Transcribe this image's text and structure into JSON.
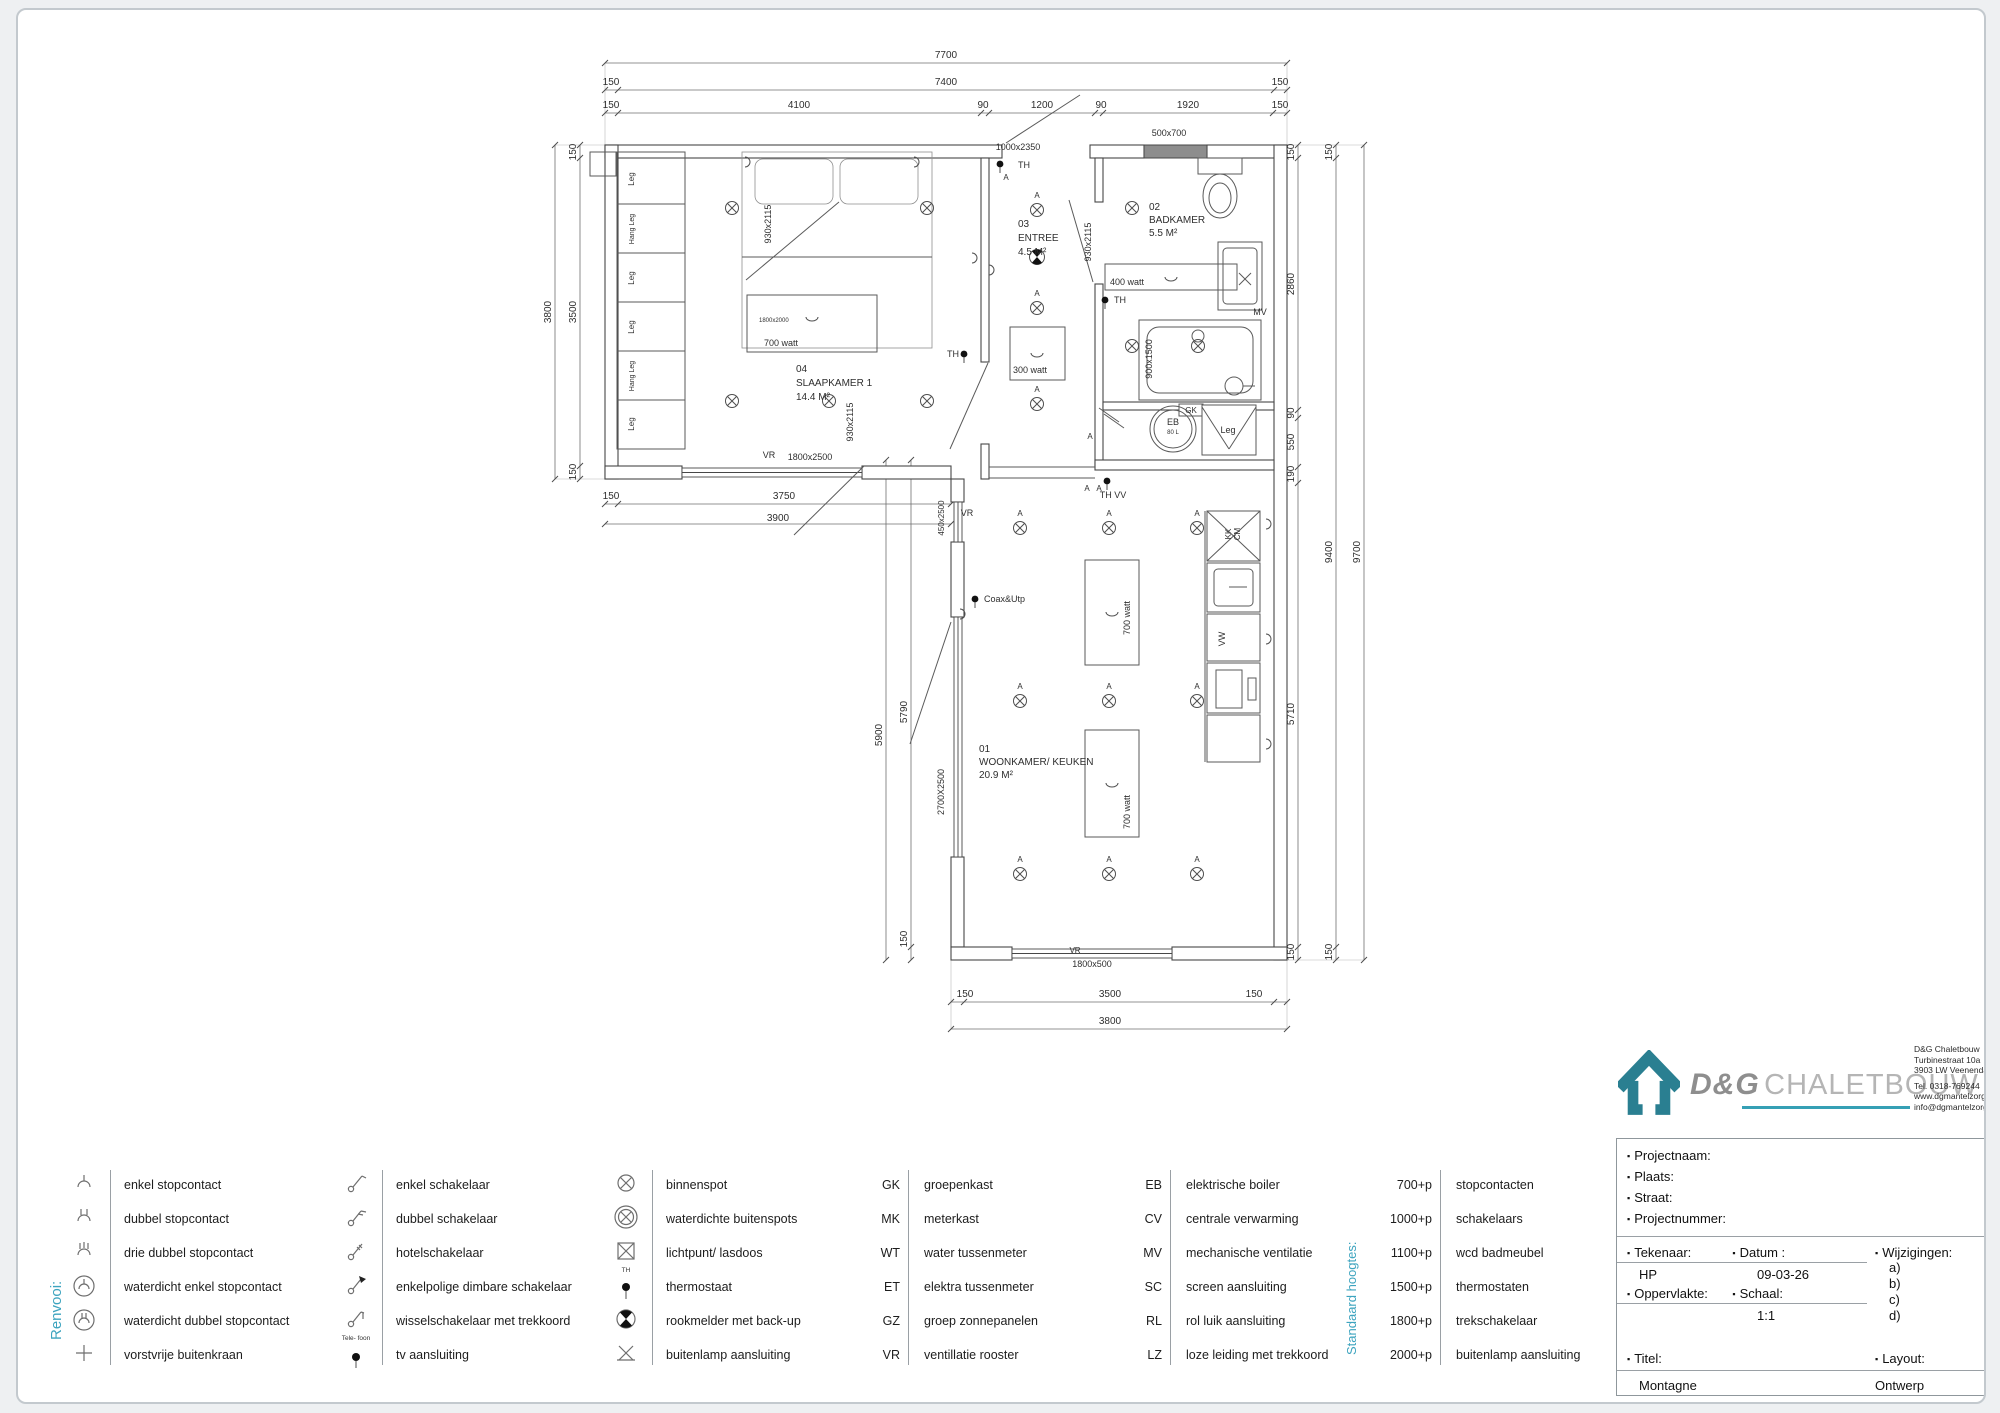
{
  "colors": {
    "teal_accent": "#3da4bf",
    "logo_teal": "#2a7f91",
    "line_dark": "#474747",
    "line_dim": "#6f6f6f"
  },
  "plan": {
    "labels": [
      [
        "7700",
        944,
        56,
        0,
        "middle",
        10
      ],
      [
        "150",
        609,
        83,
        0,
        "middle",
        10
      ],
      [
        "7400",
        944,
        83,
        0,
        "middle",
        10
      ],
      [
        "150",
        1278,
        83,
        0,
        "middle",
        10
      ],
      [
        "150",
        609,
        106,
        0,
        "middle",
        10
      ],
      [
        "4100",
        797,
        106,
        0,
        "middle",
        10
      ],
      [
        "90",
        981,
        106,
        0,
        "middle",
        10
      ],
      [
        "1200",
        1040,
        106,
        0,
        "middle",
        10
      ],
      [
        "90",
        1099,
        106,
        0,
        "middle",
        10
      ],
      [
        "1920",
        1186,
        106,
        0,
        "middle",
        10
      ],
      [
        "150",
        1278,
        106,
        0,
        "middle",
        10
      ],
      [
        "3800",
        549,
        310,
        -90,
        "middle",
        10
      ],
      [
        "150",
        574,
        150,
        -90,
        "middle",
        10
      ],
      [
        "3500",
        574,
        310,
        -90,
        "middle",
        10
      ],
      [
        "150",
        574,
        470,
        -90,
        "middle",
        10
      ],
      [
        "5900",
        880,
        733,
        -90,
        "middle",
        10
      ],
      [
        "5790",
        905,
        710,
        -90,
        "middle",
        10
      ],
      [
        "150",
        905,
        937,
        -90,
        "middle",
        10
      ],
      [
        "150",
        609,
        497,
        0,
        "middle",
        10
      ],
      [
        "3750",
        782,
        497,
        0,
        "middle",
        10
      ],
      [
        "3900",
        776,
        519,
        0,
        "middle",
        10
      ],
      [
        "150",
        1292,
        150,
        -90,
        "middle",
        10
      ],
      [
        "2860",
        1292,
        282,
        -90,
        "middle",
        10
      ],
      [
        "90",
        1292,
        411,
        -90,
        "middle",
        10
      ],
      [
        "550",
        1292,
        440,
        -90,
        "middle",
        10
      ],
      [
        "190",
        1292,
        472,
        -90,
        "middle",
        10
      ],
      [
        "5710",
        1292,
        712,
        -90,
        "middle",
        10
      ],
      [
        "150",
        1292,
        950,
        -90,
        "middle",
        10
      ],
      [
        "150",
        1330,
        150,
        -90,
        "middle",
        10
      ],
      [
        "9400",
        1330,
        550,
        -90,
        "middle",
        10
      ],
      [
        "150",
        1330,
        950,
        -90,
        "middle",
        10
      ],
      [
        "9700",
        1358,
        550,
        -90,
        "middle",
        10
      ],
      [
        "150",
        963,
        995,
        0,
        "middle",
        10
      ],
      [
        "3500",
        1108,
        995,
        0,
        "middle",
        10
      ],
      [
        "150",
        1252,
        995,
        0,
        "middle",
        10
      ],
      [
        "3800",
        1108,
        1022,
        0,
        "middle",
        10
      ],
      [
        "500x700",
        1167,
        134,
        0,
        "middle",
        9
      ],
      [
        "1000x2350",
        1016,
        148,
        0,
        "middle",
        9
      ],
      [
        "TH",
        1016,
        166,
        0,
        "start",
        9
      ],
      [
        "A",
        1004,
        178,
        0,
        "middle",
        8
      ],
      [
        "930x2115",
        769,
        222,
        -90,
        "middle",
        9
      ],
      [
        "930x2115",
        851,
        420,
        -90,
        "middle",
        9
      ],
      [
        "930x2115",
        1089,
        240,
        -90,
        "middle",
        9
      ],
      [
        "VR",
        767,
        456,
        0,
        "middle",
        9
      ],
      [
        "1800x2500",
        808,
        458,
        0,
        "middle",
        9
      ],
      [
        "450x2500",
        942,
        516,
        -90,
        "middle",
        8
      ],
      [
        "VR",
        965,
        514,
        0,
        "middle",
        9
      ],
      [
        "2700X2500",
        942,
        790,
        -90,
        "middle",
        9
      ],
      [
        "VR",
        1073,
        951,
        0,
        "middle",
        8
      ],
      [
        "1800x500",
        1090,
        965,
        0,
        "middle",
        9
      ],
      [
        "900x1500",
        1150,
        357,
        -90,
        "middle",
        9
      ],
      [
        "MV",
        1258,
        313,
        0,
        "middle",
        9
      ],
      [
        "400 watt",
        1108,
        283,
        0,
        "start",
        9
      ],
      [
        "300 watt",
        1011,
        371,
        0,
        "start",
        9
      ],
      [
        "700 watt",
        762,
        344,
        0,
        "start",
        9
      ],
      [
        "1800x2000",
        757,
        320,
        0,
        "start",
        6
      ],
      [
        "700 watt",
        1128,
        616,
        -90,
        "middle",
        9
      ],
      [
        "700 watt",
        1128,
        810,
        -90,
        "middle",
        9
      ],
      [
        "TH",
        957,
        355,
        0,
        "end",
        9
      ],
      [
        "TH",
        1112,
        301,
        0,
        "start",
        9
      ],
      [
        "TH VV",
        1111,
        496,
        0,
        "middle",
        9
      ],
      [
        "A",
        1085,
        489,
        0,
        "middle",
        8
      ],
      [
        "A",
        1097,
        489,
        0,
        "middle",
        8
      ],
      [
        "A",
        1088,
        437,
        0,
        "middle",
        8
      ],
      [
        "Coax&Utp",
        982,
        600,
        0,
        "start",
        9
      ],
      [
        "EB",
        1171,
        423,
        0,
        "middle",
        9
      ],
      [
        "80 L",
        1171,
        432,
        0,
        "middle",
        6
      ],
      [
        "GK",
        1189,
        411,
        0,
        "middle",
        8
      ],
      [
        "Leg",
        1226,
        431,
        0,
        "middle",
        9
      ],
      [
        "CM",
        1238,
        532,
        -90,
        "middle",
        8
      ],
      [
        "KK",
        1229,
        532,
        -90,
        "middle",
        8
      ],
      [
        "VW",
        1223,
        637,
        -90,
        "middle",
        9
      ],
      [
        "Leg",
        632,
        177,
        -90,
        "middle",
        8
      ],
      [
        "Hang Leg",
        632,
        227,
        -90,
        "middle",
        7
      ],
      [
        "Leg",
        632,
        276,
        -90,
        "middle",
        8
      ],
      [
        "Leg",
        632,
        325,
        -90,
        "middle",
        8
      ],
      [
        "Hang Leg",
        632,
        374,
        -90,
        "middle",
        7
      ],
      [
        "Leg",
        632,
        422,
        -90,
        "middle",
        8
      ],
      [
        "04",
        794,
        370,
        0,
        "start",
        10
      ],
      [
        "SLAAPKAMER 1",
        794,
        384,
        0,
        "start",
        10
      ],
      [
        "14.4 M²",
        794,
        398,
        0,
        "start",
        10
      ],
      [
        "03",
        1016,
        225,
        0,
        "start",
        10
      ],
      [
        "ENTREE",
        1016,
        239,
        0,
        "start",
        10
      ],
      [
        "4.5 M²",
        1016,
        253,
        0,
        "start",
        10
      ],
      [
        "02",
        1147,
        208,
        0,
        "start",
        10
      ],
      [
        "BADKAMER",
        1147,
        221,
        0,
        "start",
        10
      ],
      [
        "5.5 M²",
        1147,
        234,
        0,
        "start",
        10
      ],
      [
        "01",
        977,
        750,
        0,
        "start",
        10
      ],
      [
        "WOONKAMER/ KEUKEN",
        977,
        763,
        0,
        "start",
        10
      ],
      [
        "20.9 M²",
        977,
        776,
        0,
        "start",
        10
      ],
      [
        "A",
        1035,
        196,
        0,
        "middle",
        8
      ],
      [
        "A",
        1035,
        294,
        0,
        "middle",
        8
      ],
      [
        "A",
        1035,
        390,
        0,
        "middle",
        8
      ],
      [
        "A",
        1018,
        514,
        0,
        "middle",
        8
      ],
      [
        "A",
        1107,
        514,
        0,
        "middle",
        8
      ],
      [
        "A",
        1195,
        514,
        0,
        "middle",
        8
      ],
      [
        "A",
        1018,
        687,
        0,
        "middle",
        8
      ],
      [
        "A",
        1107,
        687,
        0,
        "middle",
        8
      ],
      [
        "A",
        1195,
        687,
        0,
        "middle",
        8
      ],
      [
        "A",
        1018,
        860,
        0,
        "middle",
        8
      ],
      [
        "A",
        1107,
        860,
        0,
        "middle",
        8
      ],
      [
        "A",
        1195,
        860,
        0,
        "middle",
        8
      ]
    ]
  },
  "legend": {
    "title": "Renvooi:",
    "col1": [
      {
        "sym": "socket1",
        "label": "enkel stopcontact"
      },
      {
        "sym": "socket2",
        "label": "dubbel stopcontact"
      },
      {
        "sym": "socket3",
        "label": "drie dubbel stopcontact"
      },
      {
        "sym": "socket1w",
        "label": "waterdicht enkel stopcontact"
      },
      {
        "sym": "socket2w",
        "label": "waterdicht dubbel stopcontact"
      },
      {
        "sym": "tap",
        "label": "vorstvrije buitenkraan"
      }
    ],
    "col2": [
      {
        "sym": "sw1",
        "label": "enkel schakelaar"
      },
      {
        "sym": "sw2",
        "label": "dubbel schakelaar"
      },
      {
        "sym": "swh",
        "label": "hotelschakelaar"
      },
      {
        "sym": "swd",
        "label": "enkelpolige dimbare schakelaar"
      },
      {
        "sym": "swp",
        "label": "wisselschakelaar met trekkoord"
      },
      {
        "sym": "tv",
        "label": "tv aansluiting",
        "note": "Tele-\nfoon"
      }
    ],
    "col3": [
      {
        "sym": "spotin",
        "label": "binnenspot"
      },
      {
        "sym": "spotout",
        "label": "waterdichte buitenspots"
      },
      {
        "sym": "junction",
        "label": "lichtpunt/ lasdoos"
      },
      {
        "sym": "thermo",
        "label": "thermostaat",
        "note": "TH"
      },
      {
        "sym": "smoke",
        "label": "rookmelder met back-up"
      },
      {
        "sym": "outlamp",
        "label": "buitenlamp aansluiting"
      }
    ],
    "col4": [
      {
        "abbr": "GK",
        "label": "groepenkast"
      },
      {
        "abbr": "MK",
        "label": "meterkast"
      },
      {
        "abbr": "WT",
        "label": "water tussenmeter"
      },
      {
        "abbr": "ET",
        "label": "elektra tussenmeter"
      },
      {
        "abbr": "GZ",
        "label": "groep zonnepanelen"
      },
      {
        "abbr": "VR",
        "label": "ventillatie rooster"
      }
    ],
    "col5": [
      {
        "abbr": "EB",
        "label": "elektrische boiler"
      },
      {
        "abbr": "CV",
        "label": "centrale verwarming"
      },
      {
        "abbr": "MV",
        "label": "mechanische ventilatie"
      },
      {
        "abbr": "SC",
        "label": "screen aansluiting"
      },
      {
        "abbr": "RL",
        "label": "rol luik aansluiting"
      },
      {
        "abbr": "LZ",
        "label": "loze leiding met trekkoord"
      }
    ],
    "heights": {
      "title": "Standaard hoogtes:",
      "items": [
        {
          "value": "700+p",
          "label": "stopcontacten"
        },
        {
          "value": "1000+p",
          "label": "schakelaars"
        },
        {
          "value": "1100+p",
          "label": "wcd badmeubel"
        },
        {
          "value": "1500+p",
          "label": "thermostaten"
        },
        {
          "value": "1800+p",
          "label": "trekschakelaar"
        },
        {
          "value": "2000+p",
          "label": "buitenlamp aansluiting"
        }
      ]
    }
  },
  "titleblock": {
    "bullet": "▪",
    "brand_bold": "D&G",
    "brand_light": "CHALETBOUW",
    "address": [
      "D&G Chaletbouw",
      "Turbinestraat 10a",
      "3903 LW Veenendaal",
      "",
      "Tel. 0318-769244",
      "www.dgmantelzorgwoningen.nl",
      "info@dgmantelzorgwoningen.nl"
    ],
    "projectnaam_label": "Projectnaam:",
    "plaats_label": "Plaats:",
    "straat_label": "Straat:",
    "projectnummer_label": "Projectnummer:",
    "tekenaar_label": "Tekenaar:",
    "tekenaar_value": "HP",
    "datum_label": "Datum :",
    "datum_value": "09-03-26",
    "wijzigingen_label": "Wijzigingen:",
    "wijzigingen_items": [
      "a)",
      "b)",
      "c)",
      "d)"
    ],
    "oppervlakte_label": "Oppervlakte:",
    "schaal_label": "Schaal:",
    "schaal_value": "1:1",
    "titel_label": "Titel:",
    "titel_value": "Montagne",
    "layout_label": "Layout:",
    "layout_value": "Ontwerp"
  }
}
